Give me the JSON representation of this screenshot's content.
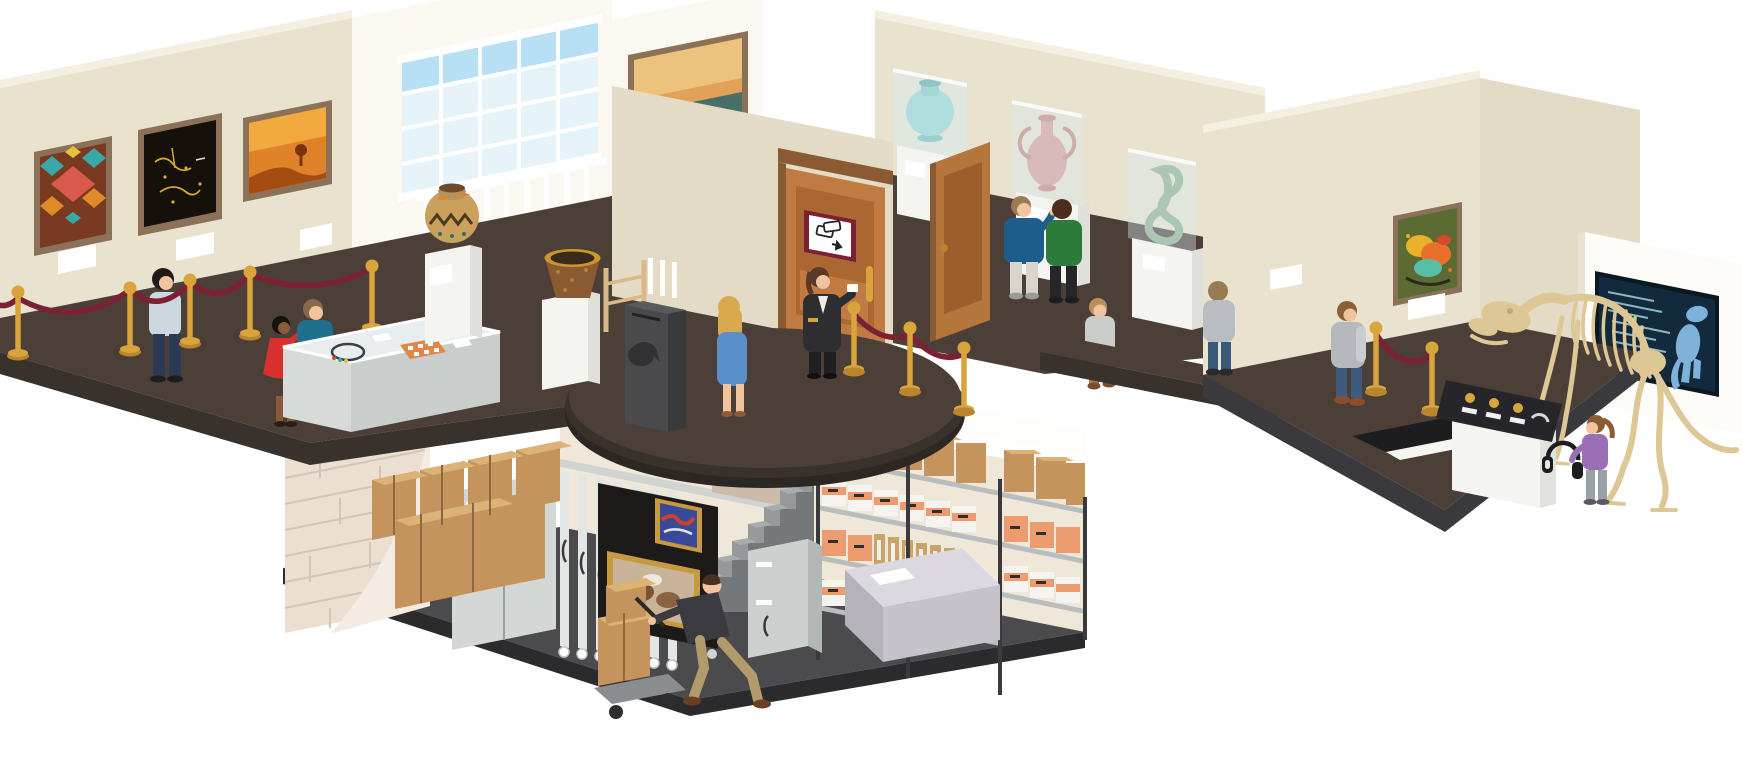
{
  "illustration": {
    "type": "isometric-museum-cutaway",
    "rooms": {
      "left_gallery": {
        "artworks": [
          "geometric-textile-art",
          "dark-gold-abstract-painting",
          "desert-sunset-painting"
        ],
        "objects": [
          "velvet-rope-stanchions",
          "jewelry-display-case",
          "patterned-pot-pedestal",
          "woven-basket-pedestal",
          "large-window",
          "donation-box",
          "wood-ladder"
        ],
        "visitors": [
          "man-light-shirt",
          "woman-red-dress",
          "man-teal-shirt"
        ]
      },
      "entrance": {
        "objects": [
          "wooden-double-door",
          "tickets-sign",
          "gold-door-handle"
        ],
        "people": [
          "ticket-attendant",
          "blonde-woman-blue-dress"
        ]
      },
      "artifact_hall": {
        "artworks": [
          "seascape-painting"
        ],
        "exhibits": [
          "teal-vase-glass-case",
          "pink-amphora-glass-case",
          "jade-sculpture-glass-case"
        ],
        "equipment": [
          "security-camera"
        ],
        "visitors": [
          "man-blue-sweater",
          "man-green-sweater",
          "boy-gray-shirt"
        ]
      },
      "right_gallery": {
        "artworks": [
          "abstract-splash-painting"
        ],
        "exhibits": [
          "dinosaur-skeleton",
          "dinosaur-info-screen",
          "audio-guide-kiosk",
          "floor-stair-opening"
        ],
        "visitors": [
          "visitor-gray-hoodie",
          "visitor-gray-sweater",
          "girl-purple-top-headphones"
        ]
      },
      "basement_archive": {
        "objects": [
          "brick-cutaway-corner",
          "cardboard-box-rows",
          "storage-lockers",
          "sliding-painting-racks",
          "framed-painting-red-blue",
          "framed-painting-brown-abstract",
          "staircase",
          "archive-shelving",
          "archive-boxes",
          "storage-cabinet",
          "work-table",
          "hand-cart"
        ],
        "people": [
          "worker-pushing-cart"
        ]
      }
    }
  },
  "colors": {
    "background": "#ffffff",
    "wall": "#e9e2cf",
    "wall_dark": "#e3dbc5",
    "wall_top": "#f4efe1",
    "wall_white": "#faf8f0",
    "wall_bright": "#fdfcf8",
    "floor": "#4c3f37",
    "floor_side": "#38312c",
    "floor_rim": "#2c2723",
    "basement_wall": "#efe8d9",
    "basement_wall_light": "#fdfdf9",
    "basement_floor": "#4b4b4e",
    "basement_floor_side": "#2b2b2e",
    "brick": "#eadfd0",
    "brick_line": "#d7c5b4",
    "brick_curl": "#f4ece2",
    "gold": "#d9a43c",
    "gold_dark": "#b9862e",
    "rope": "#7c2033",
    "wood": "#c07a42",
    "wood_dark": "#9c5e2c",
    "door_frame": "#8a5a33",
    "frame_brown": "#8a7158",
    "sign_red": "#7c2033",
    "pedestal": "#f4f4f1",
    "pedestal_side": "#e0e0da",
    "glass": "#d8ecef",
    "teal": "#8ed4d0",
    "pink": "#d89a94",
    "jade": "#8fae8c",
    "skeleton": "#dcc795",
    "screen": "#13293d",
    "screen_line": "#9fd4d8",
    "screen_dino": "#7fb2d9",
    "kiosk": "#26262a",
    "cardboard": "#c4945c",
    "cardboard_top": "#dcb277",
    "archive_white": "#f5f4f0",
    "archive_orange": "#ec9c6e",
    "shelf": "#b9bdbe",
    "post": "#3a3a3d",
    "locker": "#d3d8d6",
    "rack": "#e2e6e4",
    "rack_front": "#1d1b1a",
    "stairs": "#96999c",
    "stairs_side": "#75787b",
    "stairs_wall": "#cdbbaa",
    "cabinet": "#ccd1cf",
    "table": "#dbd8df",
    "donation": "#4a4a4c",
    "skin": "#f0c49e",
    "window_sky": "#b8e0f5",
    "window_pane": "#e6f3f8"
  }
}
